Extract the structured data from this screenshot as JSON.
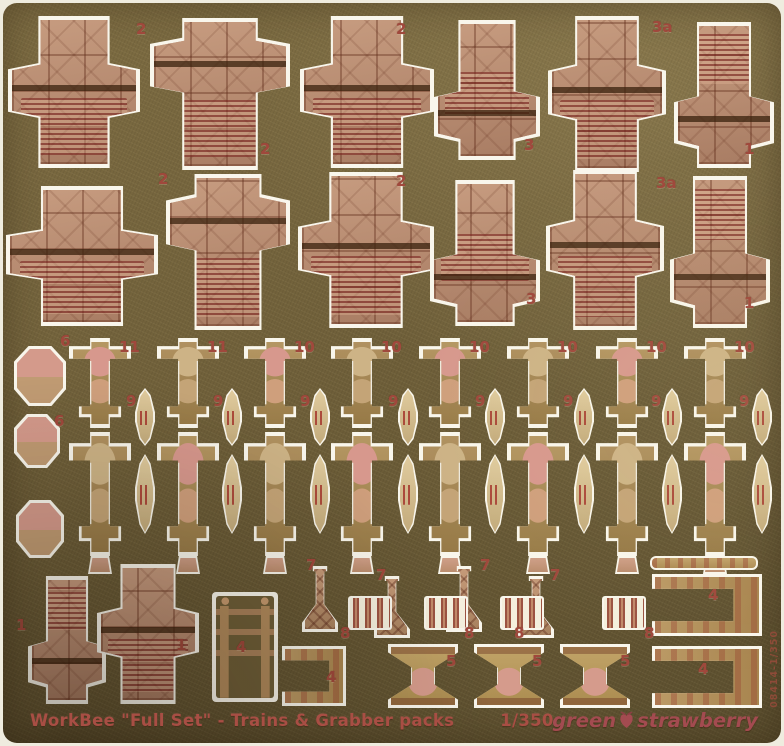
{
  "image_type": "photograph of a photo-etched brass model-kit fret on white backing",
  "sheet": {
    "caption": {
      "title": "WorkBee \"Full Set\" - Trains & Grabber packs",
      "scale": "1/350"
    },
    "brand": {
      "word_left": "green",
      "word_right": "strawberry",
      "icon": "strawberry-icon"
    },
    "edge_code": "08414-1/350",
    "colors": {
      "brass_base": "#70603a",
      "brass_dark": "#5b4e2e",
      "brass_light": "#8d7a4c",
      "copper_part": "#b5886d",
      "rib_red": "#9c4f43",
      "etch_white": "#f9f6ec",
      "label_red": "#a0483c",
      "caption_red": "#a84e44"
    },
    "part_labels": [
      {
        "text": "2",
        "x": 136,
        "y": 22
      },
      {
        "text": "2",
        "x": 260,
        "y": 142
      },
      {
        "text": "2",
        "x": 396,
        "y": 22
      },
      {
        "text": "3",
        "x": 524,
        "y": 138
      },
      {
        "text": "3a",
        "x": 652,
        "y": 20
      },
      {
        "text": "1",
        "x": 744,
        "y": 142
      },
      {
        "text": "2",
        "x": 158,
        "y": 172
      },
      {
        "text": "2",
        "x": 396,
        "y": 174
      },
      {
        "text": "3",
        "x": 526,
        "y": 292
      },
      {
        "text": "3a",
        "x": 656,
        "y": 176
      },
      {
        "text": "1",
        "x": 744,
        "y": 296
      },
      {
        "text": "6",
        "x": 60,
        "y": 334
      },
      {
        "text": "6",
        "x": 54,
        "y": 414
      },
      {
        "text": "11",
        "x": 119,
        "y": 340
      },
      {
        "text": "11",
        "x": 207,
        "y": 340
      },
      {
        "text": "10",
        "x": 294,
        "y": 340
      },
      {
        "text": "10",
        "x": 381,
        "y": 340
      },
      {
        "text": "10",
        "x": 469,
        "y": 340
      },
      {
        "text": "10",
        "x": 557,
        "y": 340
      },
      {
        "text": "10",
        "x": 646,
        "y": 340
      },
      {
        "text": "10",
        "x": 734,
        "y": 340
      },
      {
        "text": "9",
        "x": 126,
        "y": 394
      },
      {
        "text": "9",
        "x": 213,
        "y": 394
      },
      {
        "text": "9",
        "x": 300,
        "y": 394
      },
      {
        "text": "9",
        "x": 388,
        "y": 394
      },
      {
        "text": "9",
        "x": 475,
        "y": 394
      },
      {
        "text": "9",
        "x": 563,
        "y": 394
      },
      {
        "text": "9",
        "x": 651,
        "y": 394
      },
      {
        "text": "9",
        "x": 739,
        "y": 394
      },
      {
        "text": "1",
        "x": 16,
        "y": 618
      },
      {
        "text": "1",
        "x": 176,
        "y": 638
      },
      {
        "text": "4",
        "x": 236,
        "y": 640
      },
      {
        "text": "4",
        "x": 326,
        "y": 670
      },
      {
        "text": "7",
        "x": 306,
        "y": 558
      },
      {
        "text": "7",
        "x": 376,
        "y": 568
      },
      {
        "text": "7",
        "x": 480,
        "y": 558
      },
      {
        "text": "7",
        "x": 550,
        "y": 568
      },
      {
        "text": "8",
        "x": 340,
        "y": 626
      },
      {
        "text": "8",
        "x": 464,
        "y": 626
      },
      {
        "text": "8",
        "x": 514,
        "y": 626
      },
      {
        "text": "8",
        "x": 644,
        "y": 626
      },
      {
        "text": "5",
        "x": 446,
        "y": 654
      },
      {
        "text": "5",
        "x": 532,
        "y": 654
      },
      {
        "text": "5",
        "x": 620,
        "y": 654
      },
      {
        "text": "4",
        "x": 708,
        "y": 588
      },
      {
        "text": "4",
        "x": 698,
        "y": 662
      }
    ],
    "parts": [
      {
        "type": "container",
        "variant": "arm-mid ribs-low",
        "x": 8,
        "y": 16,
        "w": 132,
        "h": 152
      },
      {
        "type": "container",
        "variant": "arm-high ribs-low",
        "x": 150,
        "y": 18,
        "w": 140,
        "h": 152
      },
      {
        "type": "container",
        "variant": "arm-mid ribs-low",
        "x": 300,
        "y": 16,
        "w": 134,
        "h": 152
      },
      {
        "type": "container",
        "variant": "arm-low ribs-mid",
        "x": 434,
        "y": 20,
        "w": 106,
        "h": 140
      },
      {
        "type": "container",
        "variant": "arm-mid ribs-low",
        "x": 548,
        "y": 16,
        "w": 118,
        "h": 156
      },
      {
        "type": "container",
        "variant": "arm-low ribs-top",
        "x": 674,
        "y": 22,
        "w": 100,
        "h": 146
      },
      {
        "type": "container",
        "variant": "arm-mid ribs-low",
        "x": 6,
        "y": 186,
        "w": 152,
        "h": 140
      },
      {
        "type": "container",
        "variant": "arm-high ribs-low",
        "x": 166,
        "y": 174,
        "w": 124,
        "h": 156
      },
      {
        "type": "container",
        "variant": "arm-mid ribs-low",
        "x": 298,
        "y": 172,
        "w": 136,
        "h": 156
      },
      {
        "type": "container",
        "variant": "arm-low ribs-mid",
        "x": 430,
        "y": 180,
        "w": 110,
        "h": 146
      },
      {
        "type": "container",
        "variant": "arm-mid ribs-low",
        "x": 546,
        "y": 170,
        "w": 118,
        "h": 160
      },
      {
        "type": "container",
        "variant": "arm-low ribs-top",
        "x": 670,
        "y": 176,
        "w": 100,
        "h": 152
      },
      {
        "type": "cup",
        "variant": "",
        "x": 14,
        "y": 346,
        "w": 52,
        "h": 60
      },
      {
        "type": "cup",
        "variant": "",
        "x": 14,
        "y": 414,
        "w": 46,
        "h": 54
      },
      {
        "type": "cup",
        "variant": "",
        "x": 16,
        "y": 500,
        "w": 48,
        "h": 58
      },
      {
        "type": "totem",
        "variant": "pod-pink",
        "x": 69,
        "y": 338,
        "w": 62,
        "h": 90
      },
      {
        "type": "totem",
        "variant": "pod-tan",
        "x": 157,
        "y": 338,
        "w": 62,
        "h": 90
      },
      {
        "type": "totem",
        "variant": "pod-pink",
        "x": 244,
        "y": 338,
        "w": 62,
        "h": 90
      },
      {
        "type": "totem",
        "variant": "pod-tan",
        "x": 331,
        "y": 338,
        "w": 62,
        "h": 90
      },
      {
        "type": "totem",
        "variant": "pod-pink",
        "x": 419,
        "y": 338,
        "w": 62,
        "h": 90
      },
      {
        "type": "totem",
        "variant": "pod-tan",
        "x": 507,
        "y": 338,
        "w": 62,
        "h": 90
      },
      {
        "type": "totem",
        "variant": "pod-pink",
        "x": 596,
        "y": 338,
        "w": 62,
        "h": 90
      },
      {
        "type": "totem",
        "variant": "pod-tan",
        "x": 684,
        "y": 338,
        "w": 62,
        "h": 90
      },
      {
        "type": "totem",
        "variant": "pod-tan",
        "x": 69,
        "y": 432,
        "w": 62,
        "h": 124
      },
      {
        "type": "totem",
        "variant": "pod-pink",
        "x": 157,
        "y": 432,
        "w": 62,
        "h": 124
      },
      {
        "type": "totem",
        "variant": "pod-tan",
        "x": 244,
        "y": 432,
        "w": 62,
        "h": 124
      },
      {
        "type": "totem",
        "variant": "pod-pink",
        "x": 331,
        "y": 432,
        "w": 62,
        "h": 124
      },
      {
        "type": "totem",
        "variant": "pod-tan",
        "x": 419,
        "y": 432,
        "w": 62,
        "h": 124
      },
      {
        "type": "totem",
        "variant": "pod-pink",
        "x": 507,
        "y": 432,
        "w": 62,
        "h": 124
      },
      {
        "type": "totem",
        "variant": "pod-tan",
        "x": 596,
        "y": 432,
        "w": 62,
        "h": 124
      },
      {
        "type": "totem",
        "variant": "pod-pink",
        "x": 684,
        "y": 432,
        "w": 62,
        "h": 124
      },
      {
        "type": "spindle",
        "variant": "",
        "x": 135,
        "y": 388,
        "w": 20,
        "h": 58
      },
      {
        "type": "spindle",
        "variant": "",
        "x": 222,
        "y": 388,
        "w": 20,
        "h": 58
      },
      {
        "type": "spindle",
        "variant": "",
        "x": 310,
        "y": 388,
        "w": 20,
        "h": 58
      },
      {
        "type": "spindle",
        "variant": "",
        "x": 398,
        "y": 388,
        "w": 20,
        "h": 58
      },
      {
        "type": "spindle",
        "variant": "",
        "x": 485,
        "y": 388,
        "w": 20,
        "h": 58
      },
      {
        "type": "spindle",
        "variant": "",
        "x": 574,
        "y": 388,
        "w": 20,
        "h": 58
      },
      {
        "type": "spindle",
        "variant": "",
        "x": 662,
        "y": 388,
        "w": 20,
        "h": 58
      },
      {
        "type": "spindle",
        "variant": "",
        "x": 752,
        "y": 388,
        "w": 20,
        "h": 58
      },
      {
        "type": "spindle",
        "variant": "",
        "x": 135,
        "y": 454,
        "w": 20,
        "h": 80
      },
      {
        "type": "spindle",
        "variant": "",
        "x": 222,
        "y": 454,
        "w": 20,
        "h": 80
      },
      {
        "type": "spindle",
        "variant": "",
        "x": 310,
        "y": 454,
        "w": 20,
        "h": 80
      },
      {
        "type": "spindle",
        "variant": "",
        "x": 398,
        "y": 454,
        "w": 20,
        "h": 80
      },
      {
        "type": "spindle",
        "variant": "",
        "x": 485,
        "y": 454,
        "w": 20,
        "h": 80
      },
      {
        "type": "spindle",
        "variant": "",
        "x": 574,
        "y": 454,
        "w": 20,
        "h": 80
      },
      {
        "type": "spindle",
        "variant": "",
        "x": 662,
        "y": 454,
        "w": 20,
        "h": 80
      },
      {
        "type": "spindle",
        "variant": "",
        "x": 752,
        "y": 454,
        "w": 20,
        "h": 80
      },
      {
        "type": "stub",
        "variant": "",
        "x": 88,
        "y": 556,
        "w": 24,
        "h": 18
      },
      {
        "type": "stub",
        "variant": "",
        "x": 176,
        "y": 556,
        "w": 24,
        "h": 18
      },
      {
        "type": "stub",
        "variant": "",
        "x": 263,
        "y": 556,
        "w": 24,
        "h": 18
      },
      {
        "type": "stub",
        "variant": "",
        "x": 350,
        "y": 556,
        "w": 24,
        "h": 18
      },
      {
        "type": "stub",
        "variant": "",
        "x": 438,
        "y": 556,
        "w": 24,
        "h": 18
      },
      {
        "type": "stub",
        "variant": "",
        "x": 526,
        "y": 556,
        "w": 24,
        "h": 18
      },
      {
        "type": "stub",
        "variant": "",
        "x": 615,
        "y": 556,
        "w": 24,
        "h": 18
      },
      {
        "type": "stub",
        "variant": "",
        "x": 703,
        "y": 556,
        "w": 24,
        "h": 18
      },
      {
        "type": "container",
        "variant": "arm-low ribs-top",
        "x": 28,
        "y": 576,
        "w": 78,
        "h": 128
      },
      {
        "type": "container",
        "variant": "arm-mid ribs-low",
        "x": 97,
        "y": 564,
        "w": 102,
        "h": 140
      },
      {
        "type": "hframe",
        "variant": "",
        "x": 212,
        "y": 592,
        "w": 66,
        "h": 110
      },
      {
        "type": "tower",
        "variant": "",
        "x": 302,
        "y": 566,
        "w": 36,
        "h": 66
      },
      {
        "type": "tower",
        "variant": "",
        "x": 374,
        "y": 576,
        "w": 36,
        "h": 62
      },
      {
        "type": "tower",
        "variant": "",
        "x": 446,
        "y": 566,
        "w": 36,
        "h": 66
      },
      {
        "type": "tower",
        "variant": "",
        "x": 518,
        "y": 576,
        "w": 36,
        "h": 62
      },
      {
        "type": "pins",
        "variant": "",
        "x": 348,
        "y": 596,
        "w": 44,
        "h": 34
      },
      {
        "type": "pins",
        "variant": "",
        "x": 424,
        "y": 596,
        "w": 44,
        "h": 34
      },
      {
        "type": "pins",
        "variant": "",
        "x": 500,
        "y": 596,
        "w": 44,
        "h": 34
      },
      {
        "type": "pins",
        "variant": "",
        "x": 602,
        "y": 596,
        "w": 44,
        "h": 34
      },
      {
        "type": "anvil",
        "variant": "",
        "x": 388,
        "y": 644,
        "w": 70,
        "h": 64
      },
      {
        "type": "anvil",
        "variant": "",
        "x": 474,
        "y": 644,
        "w": 70,
        "h": 64
      },
      {
        "type": "anvil",
        "variant": "",
        "x": 560,
        "y": 644,
        "w": 70,
        "h": 64
      },
      {
        "type": "cbracket",
        "variant": "cbracket-left",
        "x": 282,
        "y": 646,
        "w": 64,
        "h": 60
      },
      {
        "type": "cbracket",
        "variant": "cbracket-left",
        "x": 652,
        "y": 574,
        "w": 110,
        "h": 62
      },
      {
        "type": "cbracket",
        "variant": "cbracket-left",
        "x": 652,
        "y": 646,
        "w": 110,
        "h": 62
      },
      {
        "type": "bar",
        "variant": "",
        "x": 650,
        "y": 556,
        "w": 108,
        "h": 14
      }
    ]
  }
}
